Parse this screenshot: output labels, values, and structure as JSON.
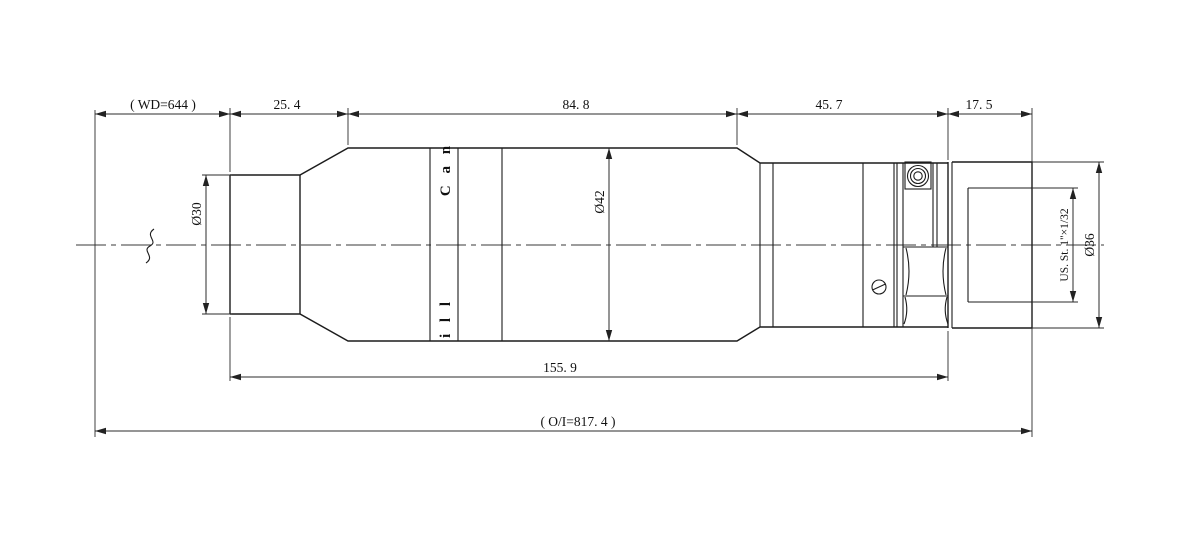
{
  "drawing": {
    "title": "Lens mechanical outline drawing",
    "units": "mm",
    "colors": {
      "line": "#1c1c1c",
      "dimension": "#2b2b2b",
      "background": "#ffffff",
      "text": "#111111"
    }
  },
  "dimensions": {
    "working_distance": "( WD=644 )",
    "front_length": "25. 4",
    "body_length": "84. 8",
    "rear_length": "45. 7",
    "mount_length": "17. 5",
    "barrel_length": "155. 9",
    "object_image_distance": "( O/I=817. 4 )",
    "front_diameter": "Ø30",
    "body_diameter": "Ø42",
    "mount_diameter": "Ø36",
    "mount_thread": "US. St. 1\"×1/32"
  },
  "barrel_marking": {
    "start": "C a n",
    "end": "i l l"
  }
}
